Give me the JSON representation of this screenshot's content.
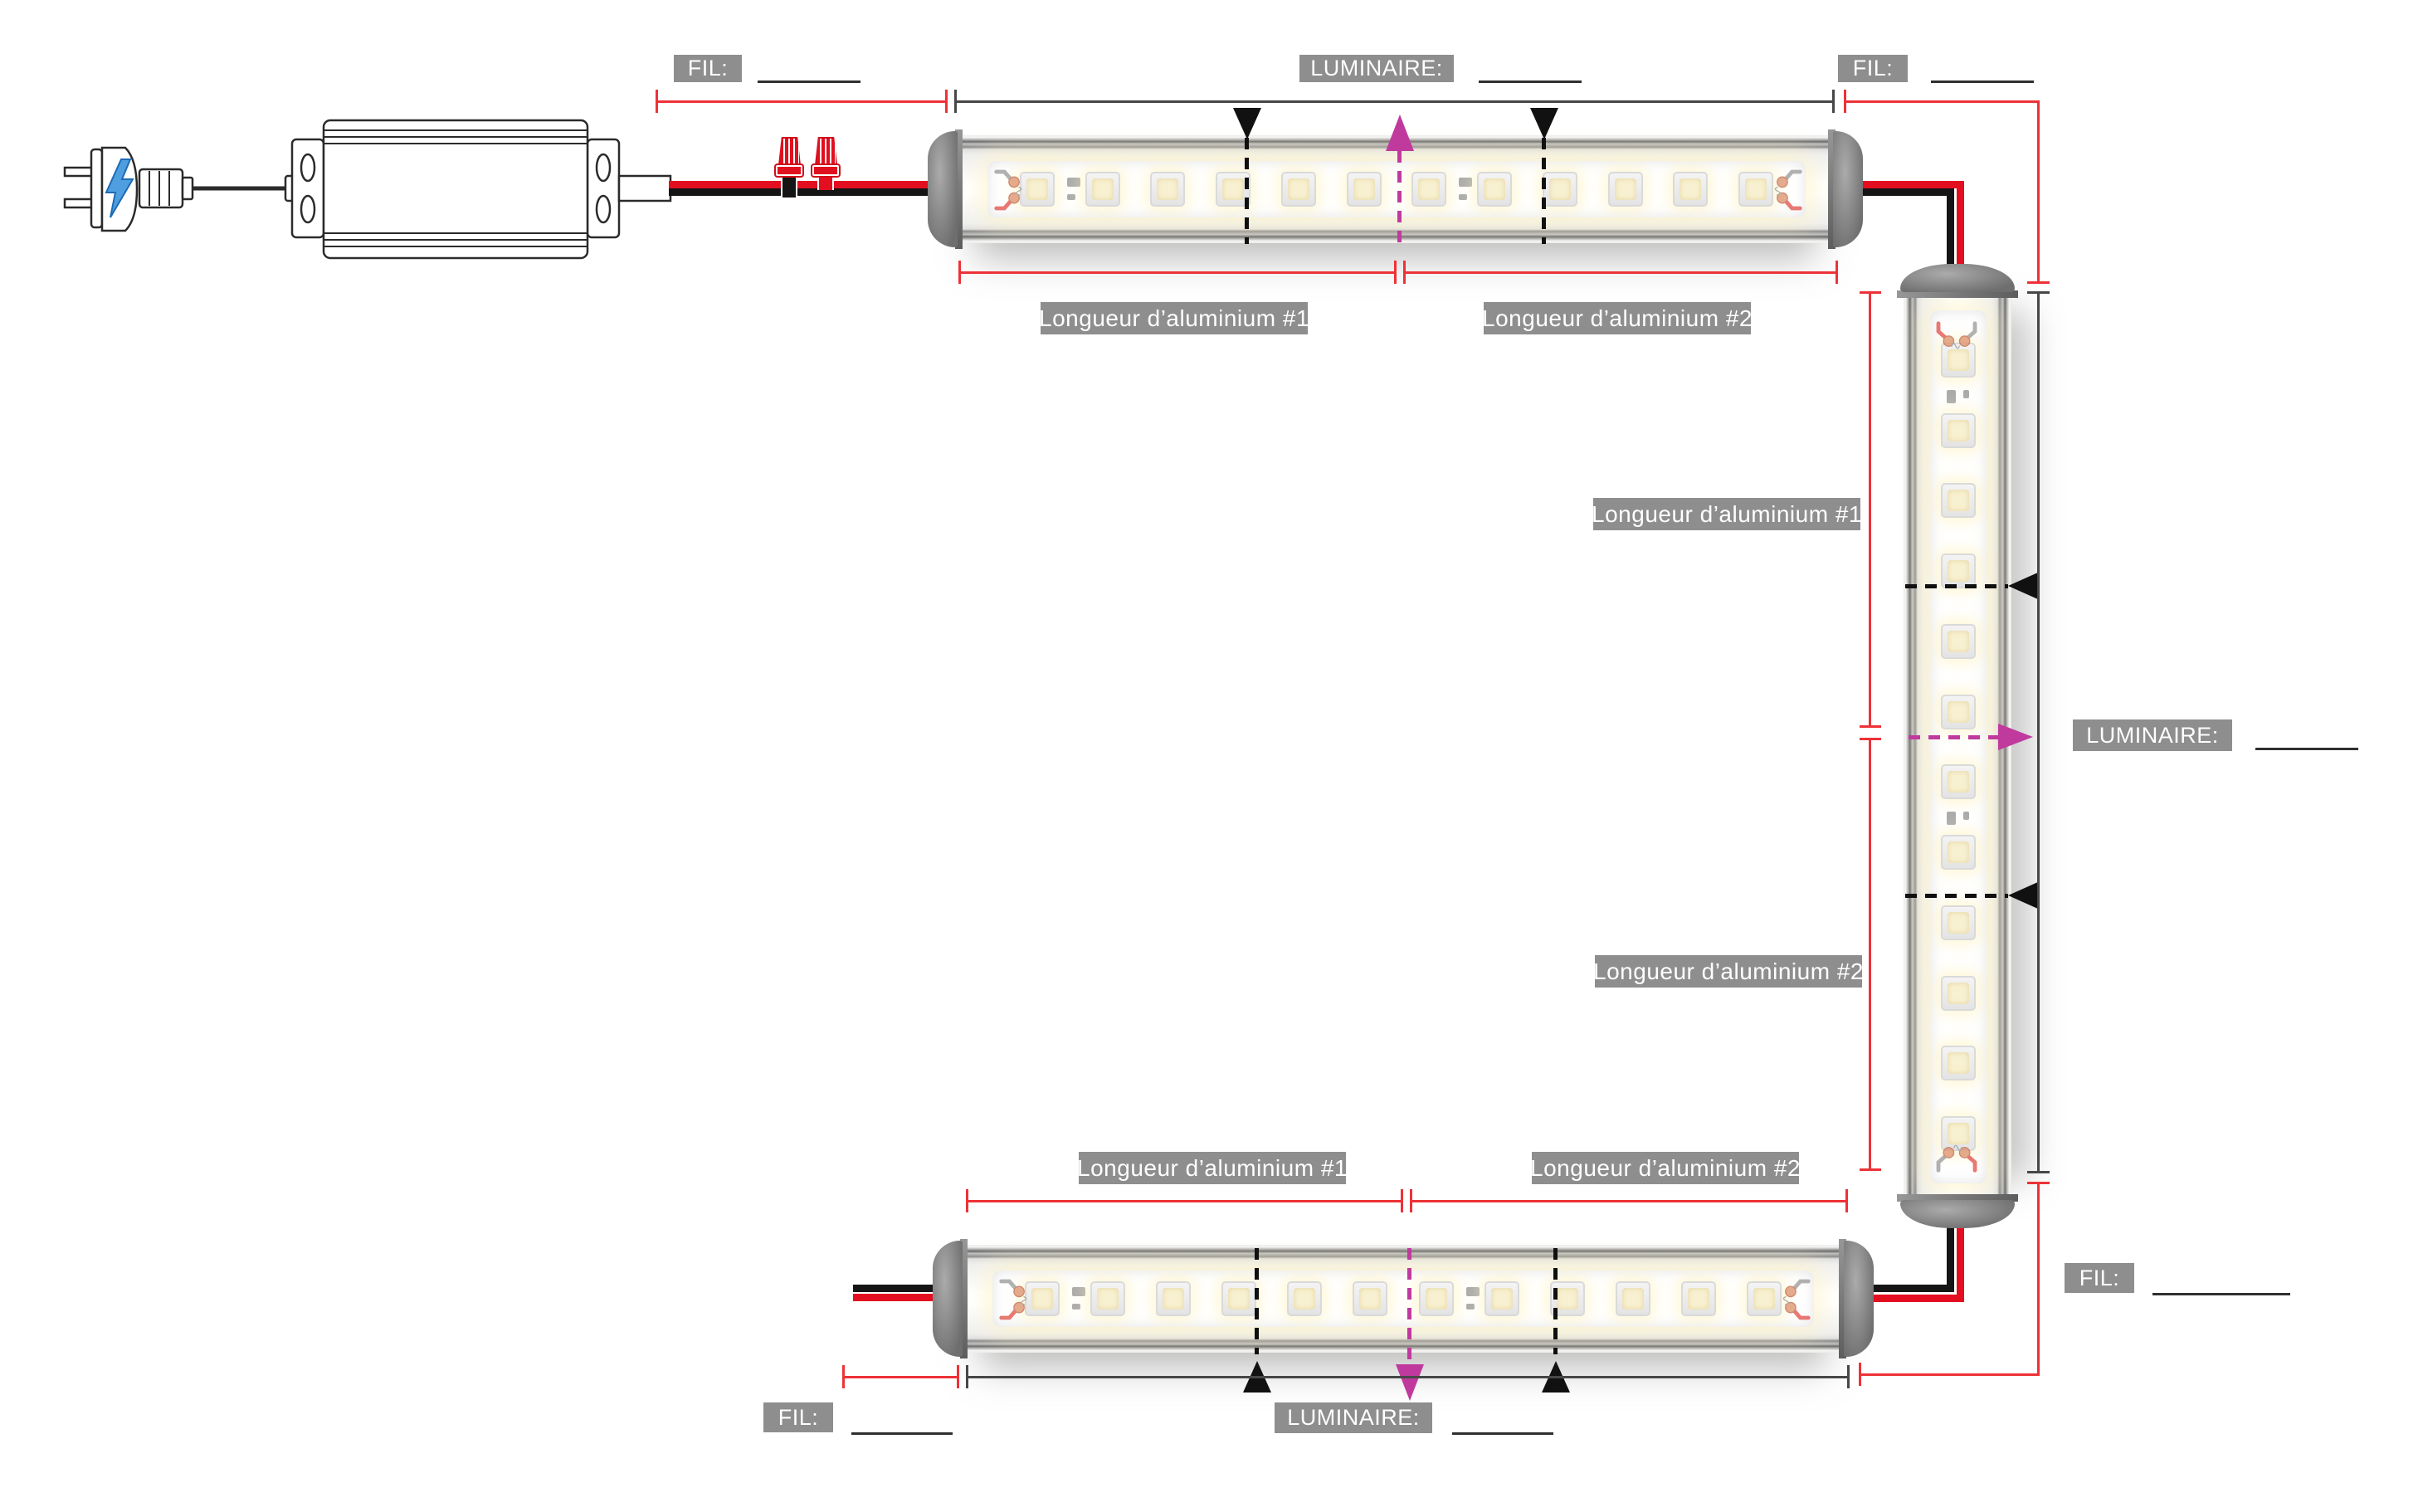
{
  "labels": {
    "fil": "FIL:",
    "luminaire": "LUMINAIRE:",
    "alu1": "Longueur d’aluminium #1",
    "alu2": "Longueur d’aluminium #2"
  },
  "fields": {
    "fil_top_left": "",
    "luminaire_top": "",
    "fil_top_right": "",
    "luminaire_right": "",
    "fil_bottom_right": "",
    "fil_bottom_left": "",
    "luminaire_bottom": ""
  },
  "colors": {
    "label_bg": "#8e8e8e",
    "dimension_red": "#ed3237",
    "dimension_dark": "#474747",
    "wire_red": "#e30f20",
    "wire_black": "#151515",
    "joint_magenta": "#c03a9e",
    "bolt_blue": "#4f9fe0"
  },
  "bars": {
    "top": {
      "leds": 12,
      "resistors_after": [
        0,
        6
      ]
    },
    "right": {
      "leds": 12,
      "resistors_after": [
        0,
        6
      ]
    },
    "bottom": {
      "leds": 12,
      "resistors_after": [
        0,
        6
      ]
    }
  }
}
